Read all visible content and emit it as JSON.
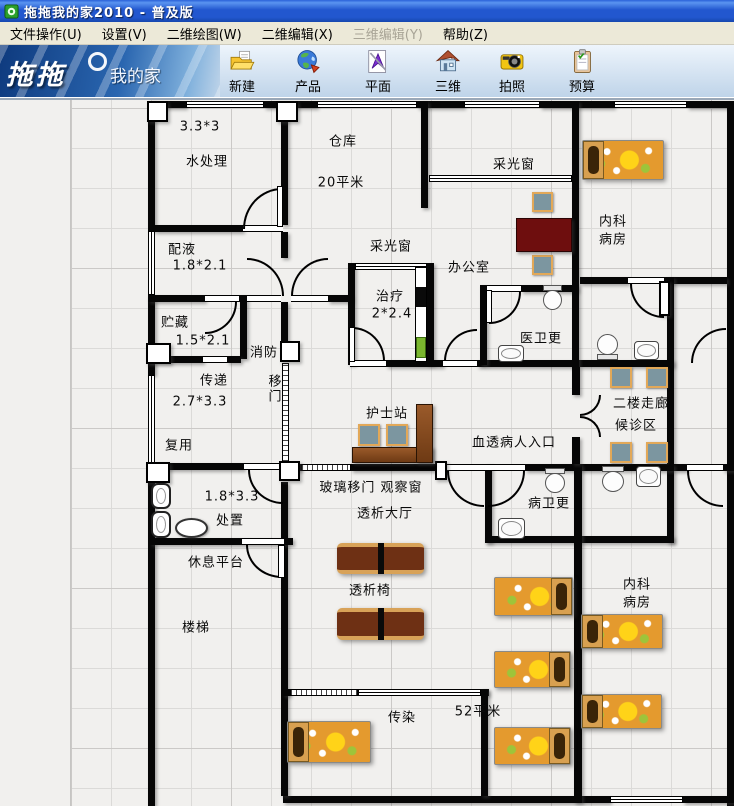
{
  "window": {
    "title": "拖拖我的家2010 - 普及版"
  },
  "menu": {
    "items": [
      {
        "label": "文件操作(U)",
        "disabled": false
      },
      {
        "label": "设置(V)",
        "disabled": false
      },
      {
        "label": "二维绘图(W)",
        "disabled": false
      },
      {
        "label": "二维编辑(X)",
        "disabled": false
      },
      {
        "label": "三维编辑(Y)",
        "disabled": true
      },
      {
        "label": "帮助(Z)",
        "disabled": false
      }
    ]
  },
  "toolbar": {
    "logo_part1": "拖拖",
    "logo_part2": "我的家",
    "buttons": [
      {
        "label": "新建",
        "icon": "new-folder-icon"
      },
      {
        "label": "产品",
        "icon": "products-globe-icon"
      },
      {
        "label": "平面",
        "icon": "plan-2d-icon"
      },
      {
        "label": "三维",
        "icon": "house-3d-icon"
      },
      {
        "label": "拍照",
        "icon": "snapshot-camera-icon"
      },
      {
        "label": "预算",
        "icon": "budget-clipboard-icon"
      }
    ]
  },
  "floorplan": {
    "labels": [
      {
        "text": "3.3*3"
      },
      {
        "text": "水处理"
      },
      {
        "text": "仓库"
      },
      {
        "text": "20平米"
      },
      {
        "text": "采光窗"
      },
      {
        "text": "内科"
      },
      {
        "text": "病房"
      },
      {
        "text": "配液"
      },
      {
        "text": "1.8*2.1"
      },
      {
        "text": "采光窗"
      },
      {
        "text": "办公室"
      },
      {
        "text": "治疗"
      },
      {
        "text": "2*2.4"
      },
      {
        "text": "医卫更"
      },
      {
        "text": "贮藏"
      },
      {
        "text": "1.5*2.1"
      },
      {
        "text": "消防"
      },
      {
        "text": "传递"
      },
      {
        "text": "移门"
      },
      {
        "text": "2.7*3.3"
      },
      {
        "text": "复用"
      },
      {
        "text": "护士站"
      },
      {
        "text": "血透病人入口"
      },
      {
        "text": "二楼走廊"
      },
      {
        "text": "候诊区"
      },
      {
        "text": "1.8*3.3"
      },
      {
        "text": "处置"
      },
      {
        "text": "玻璃移门 观察窗"
      },
      {
        "text": "透析大厅"
      },
      {
        "text": "病卫更"
      },
      {
        "text": "休息平台"
      },
      {
        "text": "透析椅"
      },
      {
        "text": "楼梯"
      },
      {
        "text": "内科"
      },
      {
        "text": "病房"
      },
      {
        "text": "传染"
      },
      {
        "text": "52平米"
      }
    ]
  },
  "colors": {
    "titlebar_blue": "#2257cf",
    "menu_bg": "#ece9d8",
    "canvas_bg": "#f1f0ee",
    "wall": "#060606",
    "bed_base": "#e49a2e",
    "bed_flower": "#ffd318",
    "chair_fill": "#7c96a0",
    "chair_border": "#e2a858",
    "wood": "#8a4e26",
    "office_table": "#6e0e0e"
  }
}
